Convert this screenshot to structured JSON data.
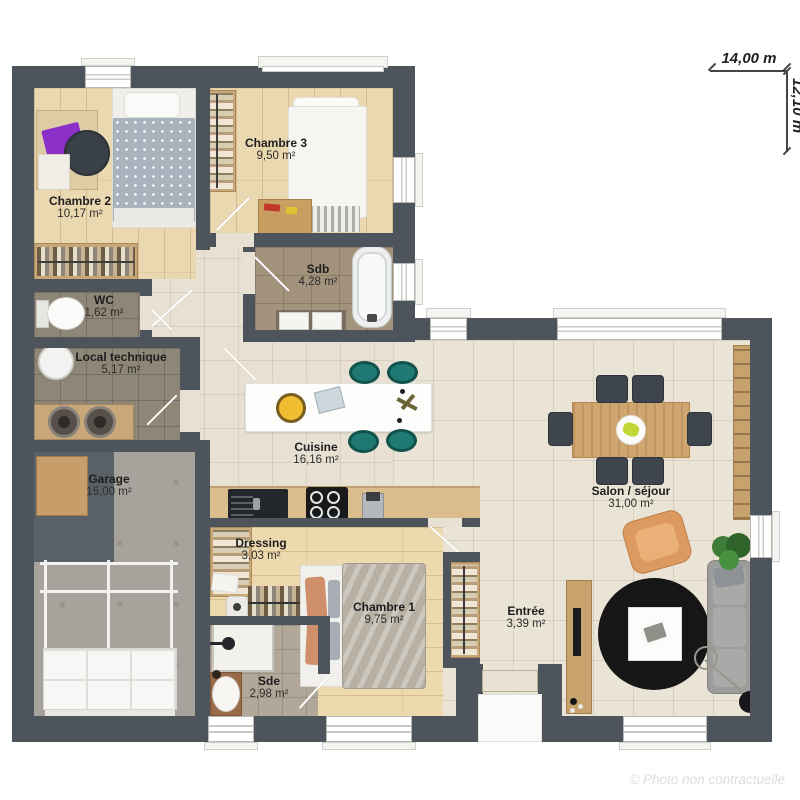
{
  "plan": {
    "dimension_width": "14,00 m",
    "dimension_height": "12,10 m",
    "watermark": "© Photo non contractuelle"
  },
  "rooms": [
    {
      "name": "Chambre 2",
      "area": "10,17 m²"
    },
    {
      "name": "Chambre 3",
      "area": "9,50 m²"
    },
    {
      "name": "Sdb",
      "area": "4,28 m²"
    },
    {
      "name": "WC",
      "area": "1,62 m²"
    },
    {
      "name": "Local technique",
      "area": "5,17 m²"
    },
    {
      "name": "Garage",
      "area": "15,00 m²"
    },
    {
      "name": "Cuisine",
      "area": "16,16 m²"
    },
    {
      "name": "Dressing",
      "area": "3,03 m²"
    },
    {
      "name": "Chambre 1",
      "area": "9,75 m²"
    },
    {
      "name": "Sde",
      "area": "2,98 m²"
    },
    {
      "name": "Entrée",
      "area": "3,39 m²"
    },
    {
      "name": "Salon / séjour",
      "area": "31,00 m²"
    }
  ],
  "colors": {
    "wall": "#4d545b",
    "wood_floor": "#ead8b0",
    "tile_floor": "#e8e1d3",
    "bath_tile": "#a3937d",
    "utility_tile": "#8e8677",
    "shower_tile": "#b2a899",
    "concrete": "#a7a29b",
    "accent_teal": "#207972",
    "accent_orange": "#dd9a60"
  }
}
